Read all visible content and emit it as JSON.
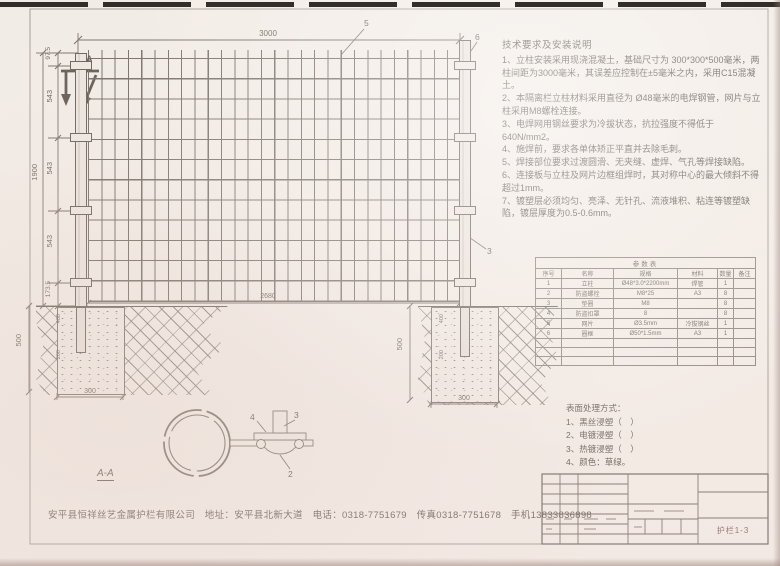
{
  "sheet": {
    "drawing_no": "护栏1-3"
  },
  "notes": {
    "title": "技术要求及安装说明",
    "items": [
      "1、立柱安装采用现浇混凝土，基础尺寸为 300*300*500毫米，两柱间距为3000毫米，其误差应控制在±5毫米之内，采用C15混凝土。",
      "2、本隔离栏立柱材料采用直径为 Ø48毫米的电焊钢管，网片与立柱采用M8螺栓连接。",
      "3、电焊网用钢丝要求为冷拔状态，抗拉强度不得低于640N/mm2。",
      "4、施焊前，要求各单体矫正平直并去除毛刺。",
      "5、焊接部位要求过渡圆滑、无夹缝、虚焊、气孔等焊接缺陷。",
      "6、连接板与立柱及网片边框组焊时，其对称中心的最大倾斜不得超过1mm。",
      "7、镀塑层必须均匀、亮泽、无针孔、流液堆积、粘连等镀塑缺陷，镀层厚度为0.5-0.6mm。"
    ]
  },
  "dimensions": {
    "top_span": "3000",
    "height_segments": [
      "97.5",
      "543",
      "543",
      "543",
      "173.5"
    ],
    "overall_height": "1900",
    "mesh_span": "2680",
    "foundation_depth": "500",
    "foundation_width": "300",
    "post_embed": "400",
    "footing_below": "200"
  },
  "callouts": {
    "mesh": "5",
    "right_post_top": "6",
    "right_post": "3",
    "section_mark": "A",
    "detail_plate": "4",
    "detail_bolt": "3",
    "detail_clamp": "2",
    "section_label": "A-A"
  },
  "parts_table": {
    "title": "参数表",
    "headers": [
      "序号",
      "名称",
      "规格",
      "材料",
      "数量",
      "备注"
    ],
    "rows": [
      [
        "1",
        "立柱",
        "Ø48*3.0*2200mm",
        "焊管",
        "1",
        ""
      ],
      [
        "2",
        "防盗螺栓",
        "M8*25",
        "A3",
        "8",
        ""
      ],
      [
        "3",
        "垫圈",
        "M8",
        "",
        "8",
        ""
      ],
      [
        "4",
        "防盗扣罩",
        "8",
        "",
        "8",
        ""
      ],
      [
        "5",
        "网片",
        "Ø3.5mm",
        "冷拔钢丝",
        "1",
        ""
      ],
      [
        "6",
        "圈框",
        "Ø50*1.5mm",
        "A3",
        "1",
        ""
      ]
    ],
    "empty_rows": 3
  },
  "surface_treatment": {
    "title": "表面处理方式：",
    "items": [
      "1、黑丝浸塑（　）",
      "2、电镀浸塑（　）",
      "3、热镀浸塑（　）",
      "4、颜色：草绿。"
    ]
  },
  "footer": {
    "company_line": "安平县恒祥丝艺金属护栏有限公司　地址：安平县北新大道　电话：0318-7751679　传真0318-7751678　手机13833836898"
  }
}
